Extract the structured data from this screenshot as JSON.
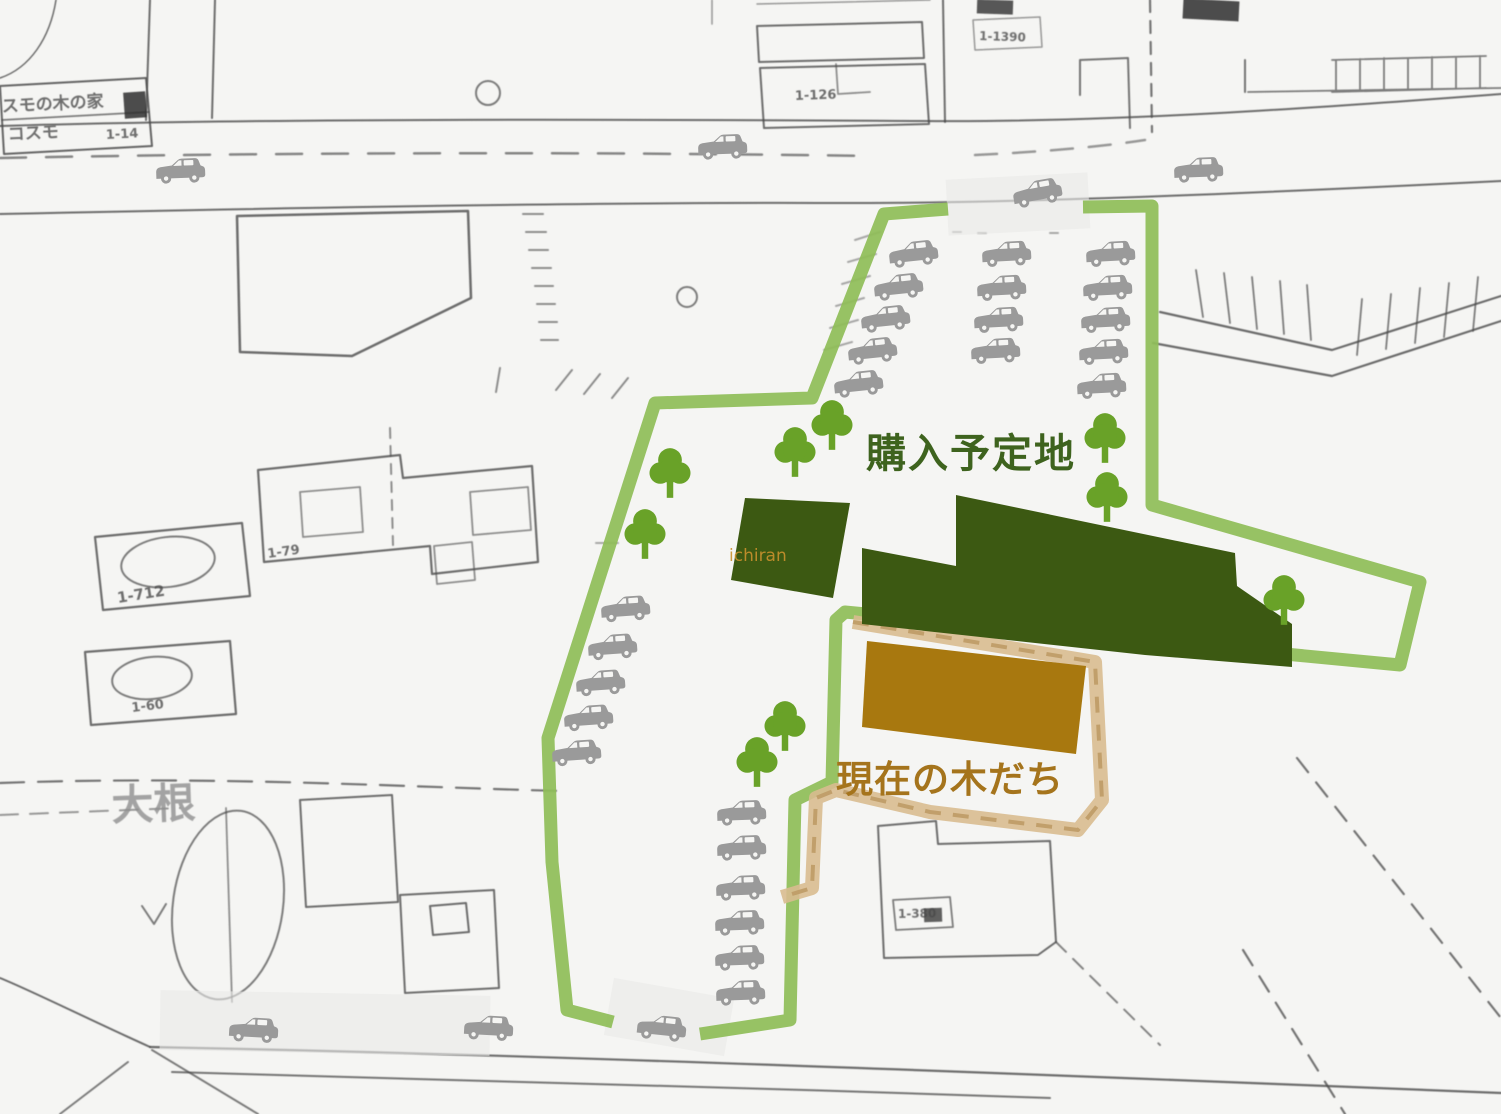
{
  "colors": {
    "paper": "#f5f5f3",
    "map_line": "#4a4a4a",
    "boundary_green": "#8fbd58",
    "tree_green": "#69a228",
    "dark_green": "#3c5912",
    "brown_area": "#a8780f",
    "tan_band": "#d9bd90",
    "tan_dash": "#bd9a64",
    "car_gray": "#9a9a9a",
    "band_gray": "#e9e9e7",
    "label_green": "#3e631e",
    "label_brown": "#a5741c"
  },
  "labels": {
    "purchase_area": "購入予定地",
    "current_trees": "現在の木だち",
    "watermark": "ichiran"
  },
  "basemap": {
    "strokes": [
      {
        "d": "M0,126 C300,117 720,120 920,121 C1120,123 1340,106 1501,94",
        "w": 2
      },
      {
        "d": "M0,214 C280,208 620,202 830,203 C1020,204 1300,191 1501,181",
        "w": 2
      },
      {
        "d": "M0,158 C300,152 600,152 870,156",
        "w": 2.5,
        "dash": "26 20",
        "o": 0.65
      },
      {
        "d": "M975,155 C1040,152 1100,147 1145,140",
        "w": 2.5,
        "dash": "22 16",
        "o": 0.55
      },
      {
        "d": "M150,0 L146,120",
        "w": 2
      },
      {
        "d": "M215,0 L212,118",
        "w": 2
      },
      {
        "d": "M0,78 C30,68 50,38 56,0",
        "w": 1.5
      },
      {
        "d": "M0,86 L146,78 L152,146 L4,154 Z",
        "w": 2,
        "o": 0.85
      },
      {
        "d": "M2,120 L149,112",
        "w": 1.8,
        "o": 0.7
      },
      {
        "d": "M237,216 L468,211 L471,298 L352,356 L240,352 Z",
        "w": 2.5
      },
      {
        "d": "M523,214 h20 M526,232 h20 M529,250 h19 M532,268 h19 M535,286 h18 M537,304 h18 M539,322 h18 M541,340 h17",
        "w": 2,
        "o": 0.6
      },
      {
        "d": "M496,392 L500,368 M556,390 L572,370 M584,394 L600,374 M612,398 L628,378",
        "w": 2,
        "o": 0.6
      },
      {
        "d": "M757,26 L922,22 L924,58 L759,62 Z",
        "w": 2,
        "o": 0.8
      },
      {
        "d": "M760,68 L925,64 L929,124 L764,128 Z",
        "w": 2,
        "o": 0.8
      },
      {
        "d": "M836,64 L838,94 L870,92",
        "w": 1.8,
        "o": 0.6
      },
      {
        "d": "M712,0 L712,24 M757,4 L930,0",
        "w": 1.5,
        "o": 0.55
      },
      {
        "d": "M943,0 L945,122",
        "w": 2
      },
      {
        "d": "M973,20 L1040,17 L1042,47 L975,50 Z",
        "w": 1.5,
        "o": 0.55
      },
      {
        "d": "M1080,95 L1080,60 L1128,58 L1130,128 M1245,92 L1245,60",
        "w": 2,
        "o": 0.75
      },
      {
        "d": "M1332,60 L1486,56 M1336,60 V92 M1360,59 V91 M1384,58 V90 M1408,58 V90 M1432,57 V89 M1456,57 V89 M1480,56 V88 M1332,92 L1486,88 M1248,92 L1501,88",
        "w": 1.8,
        "o": 0.7
      },
      {
        "d": "M1150,0 L1152,132",
        "w": 2.2,
        "dash": "12 9",
        "o": 0.75
      },
      {
        "d": "M1160,312 L1332,350 L1501,296",
        "w": 2.2
      },
      {
        "d": "M1153,343 L1332,376 L1501,321",
        "w": 2.2
      },
      {
        "d": "M1196,270 L1203,317 M1224,273 L1230,323 M1252,277 L1257,329 M1280,281 L1284,334 M1307,285 L1311,340 M1362,299 L1357,355 M1391,294 L1386,349 M1420,288 L1415,343 M1449,283 L1444,337 M1478,277 L1473,331",
        "w": 1.8,
        "o": 0.7
      },
      {
        "d": "M258,470 L400,455 L403,478 L532,466 L538,562 L432,574 L430,546 L264,562 Z",
        "w": 2.2
      },
      {
        "d": "M470,492 L528,487 L531,530 L473,535 Z M434,546 L472,542 L475,580 L437,584 Z M300,492 L360,487 L363,532 L303,537 Z",
        "w": 1.8,
        "o": 0.6
      },
      {
        "d": "M95,537 L242,523 L250,596 L103,610 Z",
        "w": 2.2
      },
      {
        "d": "M85,652 L230,641 L236,714 L91,725 Z",
        "w": 2.2
      },
      {
        "d": "M390,428 L393,545",
        "w": 2,
        "dash": "10 8",
        "o": 0.6
      },
      {
        "d": "M0,783 C220,775 420,788 565,791",
        "w": 2.2,
        "dash": "24 14",
        "o": 0.75
      },
      {
        "d": "M0,815 L180,808",
        "w": 2,
        "dash": "18 12",
        "o": 0.55
      },
      {
        "d": "M300,800 L392,795 L398,902 L306,907 Z M400,895 L494,890 L499,988 L405,993 Z M430,906 L466,903 L469,932 L433,935 Z",
        "w": 2,
        "o": 0.8
      },
      {
        "d": "M226,808 L232,1002",
        "w": 1.8,
        "o": 0.6
      },
      {
        "d": "M142,906 L154,924 L166,904",
        "w": 2,
        "o": 0.7
      },
      {
        "d": "M150,1047 C520,1054 980,1072 1501,1093",
        "w": 2.2
      },
      {
        "d": "M172,1072 C480,1080 760,1088 1050,1098",
        "w": 2,
        "o": 0.75
      },
      {
        "d": "M150,1047 C90,1020 30,990 0,978",
        "w": 2
      },
      {
        "d": "M258,1114 L152,1050 M128,1062 L60,1114",
        "w": 2,
        "o": 0.7
      },
      {
        "d": "M878,826 L936,821 L938,844 L1050,841 L1056,942 L1038,955 L884,958 Z",
        "w": 2,
        "o": 0.8
      },
      {
        "d": "M893,900 L950,897 L953,927 L896,930 Z",
        "w": 1.8,
        "o": 0.7
      },
      {
        "d": "M1056,942 L1160,1045",
        "w": 2,
        "dash": "14 10",
        "o": 0.65
      },
      {
        "d": "M1297,758 L1501,1018",
        "w": 2.2,
        "dash": "18 13",
        "o": 0.75
      },
      {
        "d": "M1243,950 L1345,1114",
        "w": 2.2,
        "dash": "18 13",
        "o": 0.75
      },
      {
        "d": "M855,240 L880,232 M848,262 L876,254 M842,284 L870,276 M836,306 L864,298 M830,328 L858,320 M824,350 L852,342",
        "w": 2,
        "o": 0.45
      },
      {
        "d": "M953,232 h8 M978,233 h8 M1050,233 h8 M596,543 h22",
        "w": 2,
        "o": 0.45
      }
    ],
    "circles": [
      {
        "cx": 488,
        "cy": 93,
        "r": 12
      },
      {
        "cx": 687,
        "cy": 297,
        "r": 10
      }
    ],
    "ellipses": [
      {
        "cx": 228,
        "cy": 905,
        "rx": 55,
        "ry": 95,
        "rot": 8
      },
      {
        "cx": 168,
        "cy": 562,
        "rx": 47,
        "ry": 25,
        "rot": -7
      },
      {
        "cx": 152,
        "cy": 678,
        "rx": 40,
        "ry": 21,
        "rot": -6
      }
    ],
    "blobs": [
      {
        "x": 1183,
        "y": 0,
        "w": 56,
        "h": 20,
        "rot": 3,
        "o": 0.85
      },
      {
        "x": 977,
        "y": 0,
        "w": 36,
        "h": 14,
        "rot": 2,
        "o": 0.8
      },
      {
        "x": 124,
        "y": 92,
        "w": 22,
        "h": 26,
        "rot": -4,
        "o": 0.85
      },
      {
        "x": 924,
        "y": 908,
        "w": 18,
        "h": 14,
        "rot": -2,
        "o": 0.75
      }
    ],
    "texts": [
      {
        "t": "スモの木の家",
        "x": 2,
        "y": 112,
        "s": 17,
        "r": -3
      },
      {
        "t": "コスモ",
        "x": 8,
        "y": 140,
        "s": 17,
        "r": -3
      },
      {
        "t": "1-14",
        "x": 106,
        "y": 139,
        "s": 13,
        "r": -3
      },
      {
        "t": "1-126",
        "x": 795,
        "y": 100,
        "s": 13,
        "r": -2
      },
      {
        "t": "1-1390",
        "x": 979,
        "y": 40,
        "s": 12,
        "r": 2
      },
      {
        "t": "1-79",
        "x": 268,
        "y": 558,
        "s": 13,
        "r": -8
      },
      {
        "t": "1-712",
        "x": 118,
        "y": 603,
        "s": 15,
        "r": -9
      },
      {
        "t": "1-60",
        "x": 132,
        "y": 712,
        "s": 13,
        "r": -7
      },
      {
        "t": "大根",
        "x": 112,
        "y": 820,
        "s": 42,
        "r": -2,
        "c": "#8f8f8f",
        "o": 0.8
      },
      {
        "t": "1-380",
        "x": 898,
        "y": 918,
        "s": 12,
        "r": -1
      }
    ]
  },
  "bands": [
    {
      "x": 947,
      "y": 176,
      "w": 142,
      "h": 56,
      "rot": -3
    },
    {
      "x": 608,
      "y": 988,
      "w": 122,
      "h": 58,
      "rot": 10
    },
    {
      "x": 160,
      "y": 993,
      "w": 330,
      "h": 60,
      "rot": 1
    }
  ],
  "overlay": {
    "green_boundary": [
      "M1083,207 L1152,206 L1152,505 L1420,582 L1400,665 L845,612 L836,620 L832,782 L795,800 L790,1020 L700,1034",
      "M613,1022 L567,1010 L552,862 L548,738 L655,403 L812,398 L884,214 L948,209"
    ],
    "tan_boundary": "M853,622 L1095,662 L1102,800 L1078,830 L930,812 L836,790 L816,798 L812,888 L782,897",
    "dark_buildings": [
      "M745,498 L850,503 L833,598 L731,580 Z",
      "M862,548 L956,566 L956,495 L1235,553 L1237,586 L1292,624 L1292,667 L1145,655 L862,624 Z"
    ],
    "brown_area": "M867,641 L1086,666 L1076,754 L862,727 Z",
    "trees": [
      {
        "x": 832,
        "y": 425
      },
      {
        "x": 795,
        "y": 452
      },
      {
        "x": 670,
        "y": 473
      },
      {
        "x": 645,
        "y": 534
      },
      {
        "x": 1105,
        "y": 438
      },
      {
        "x": 1107,
        "y": 497
      },
      {
        "x": 1284,
        "y": 600
      },
      {
        "x": 785,
        "y": 726
      },
      {
        "x": 757,
        "y": 762
      }
    ],
    "cars": [
      {
        "x": 180,
        "y": 172,
        "r": -2
      },
      {
        "x": 722,
        "y": 148,
        "r": -2
      },
      {
        "x": 1037,
        "y": 194,
        "r": -10
      },
      {
        "x": 1198,
        "y": 171,
        "r": -2
      },
      {
        "x": 913,
        "y": 255,
        "r": -6
      },
      {
        "x": 898,
        "y": 288,
        "r": -6
      },
      {
        "x": 885,
        "y": 320,
        "r": -6
      },
      {
        "x": 872,
        "y": 352,
        "r": -6
      },
      {
        "x": 858,
        "y": 385,
        "r": -6
      },
      {
        "x": 1006,
        "y": 255,
        "r": -3
      },
      {
        "x": 1001,
        "y": 289,
        "r": -3
      },
      {
        "x": 998,
        "y": 321,
        "r": -3
      },
      {
        "x": 995,
        "y": 352,
        "r": -3
      },
      {
        "x": 1110,
        "y": 255,
        "r": -3
      },
      {
        "x": 1107,
        "y": 289,
        "r": -3
      },
      {
        "x": 1105,
        "y": 321,
        "r": -3
      },
      {
        "x": 1103,
        "y": 353,
        "r": -3
      },
      {
        "x": 1101,
        "y": 387,
        "r": -3
      },
      {
        "x": 625,
        "y": 610,
        "r": -4
      },
      {
        "x": 612,
        "y": 648,
        "r": -4
      },
      {
        "x": 600,
        "y": 684,
        "r": -4
      },
      {
        "x": 588,
        "y": 719,
        "r": -4
      },
      {
        "x": 576,
        "y": 754,
        "r": -4
      },
      {
        "x": 741,
        "y": 814,
        "r": -2
      },
      {
        "x": 741,
        "y": 849,
        "r": -2
      },
      {
        "x": 740,
        "y": 889,
        "r": -2
      },
      {
        "x": 739,
        "y": 924,
        "r": -2
      },
      {
        "x": 739,
        "y": 959,
        "r": -2
      },
      {
        "x": 740,
        "y": 994,
        "r": -2
      },
      {
        "x": 253,
        "y": 1031,
        "r": 3
      },
      {
        "x": 488,
        "y": 1029,
        "r": 3
      },
      {
        "x": 661,
        "y": 1029,
        "r": 6
      }
    ]
  }
}
